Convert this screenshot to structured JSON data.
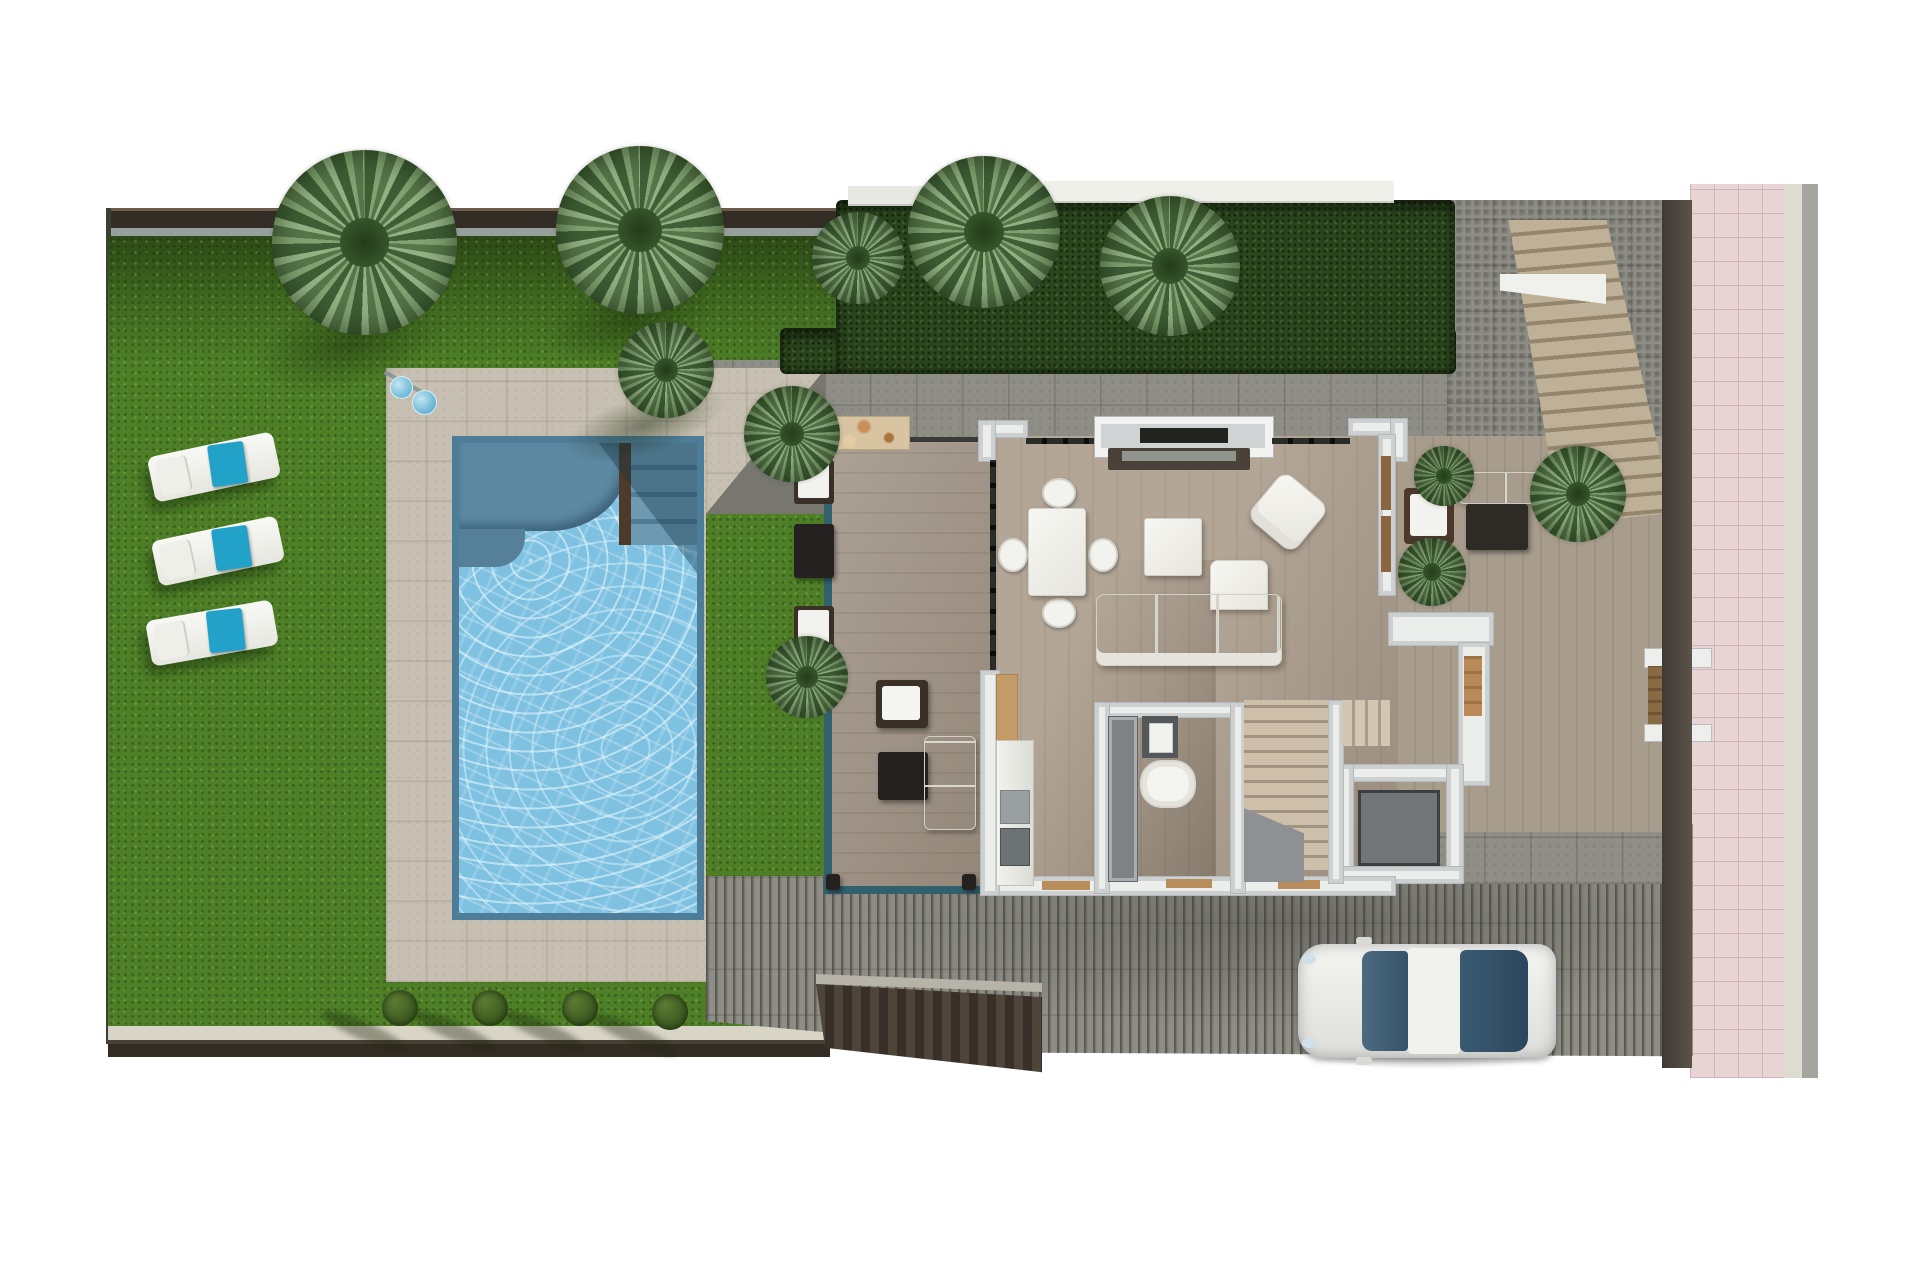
{
  "scene": {
    "kind": "3d-floor-plan-render",
    "view": "top-down",
    "level": "ground-floor",
    "background": "#ffffff"
  },
  "palette": {
    "lawn": "#4e7f27",
    "pool_water": "#7fc1e0",
    "pool_edge": "#4d7d99",
    "patio_tiles": "#c7c0b2",
    "terrace_tiles": "#8e8e87",
    "deck_wood": "#a3978a",
    "interior_wood": "#b3a697",
    "wall_white": "#eceeec",
    "wall_core_gray": "#c1c6c8",
    "hedge_green": "#2b451d",
    "perimeter_wall": "#332d26",
    "towel_teal": "#22a2c9",
    "car_body": "#f1f0ed",
    "car_glass": "#35536a",
    "sidewalk_pink": "#e8d4d5",
    "road_gray": "#a5a5a0",
    "door_wood": "#b98a58"
  },
  "garden": {
    "palm_trees": 10,
    "sun_loungers": 3,
    "bushes": 4,
    "outdoor_shower": 1
  },
  "pool": {
    "shape": "rectangular",
    "features": [
      "curved-bench",
      "entry-steps",
      "wood-divider"
    ]
  },
  "house": {
    "rooms": [
      "covered-terrace",
      "living-dining-room",
      "kitchen",
      "bathroom",
      "staircase",
      "storage-room",
      "entry-courtyard"
    ],
    "furniture": [
      "dining-table",
      "dining-chairs-x4",
      "l-shaped-sofa",
      "armchair",
      "coffee-table",
      "tv-unit",
      "tv-window",
      "outdoor-lounge-set",
      "courtyard-sofa-set",
      "bathtub",
      "bathroom-sink",
      "kitchen-counter"
    ]
  },
  "exterior": {
    "car": 1,
    "driveway_ramp": 1,
    "exterior_staircase": 1,
    "entry_gate": 1
  }
}
